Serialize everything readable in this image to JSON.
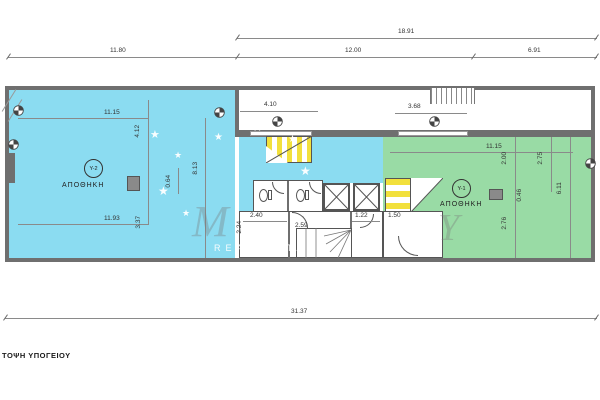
{
  "title": "ΤΟΨΗ ΥΠΟΓΕΙΟΥ",
  "colors": {
    "storage_y2": "#8bdcf1",
    "storage_y1": "#99dba5",
    "wall": "#6f6f6f",
    "stair_yellow": "#f2e03c"
  },
  "top_dims": {
    "overall": "18.91",
    "left": "11.80",
    "mid": "12.00",
    "right": "6.91"
  },
  "bottom_dim": "31.37",
  "y2": {
    "code": "Υ-2",
    "label": "ΑΠΟΘΗΚΗ",
    "dim_top": "11.15",
    "dim_v1": "4.12",
    "dim_v2": "8.13",
    "dim_v3": "0.64",
    "dim_bottom": "11.93",
    "dim_v4": "3.37"
  },
  "y1": {
    "code": "Υ-1",
    "label": "ΑΠΟΘΗΚΗ",
    "dim_top": "11.15",
    "dim_v1": "2.00",
    "dim_v2": "2.75",
    "dim_v3": "0.46",
    "dim_v4": "6.11",
    "dim_v5": "2.76"
  },
  "corridor": {
    "dim_left": "4.10",
    "dim_right": "3.68"
  },
  "core": {
    "dim_room1_w": "2.40",
    "dim_room1_h": "2.24",
    "dim_room2_w": "2.59",
    "dim_room3_w": "1.22",
    "dim_room4_w": "1.50"
  },
  "watermark": {
    "monogram_left": "M",
    "monogram_right": "Y",
    "caption": "REAL ESTATE",
    "star_glyph": "★"
  }
}
